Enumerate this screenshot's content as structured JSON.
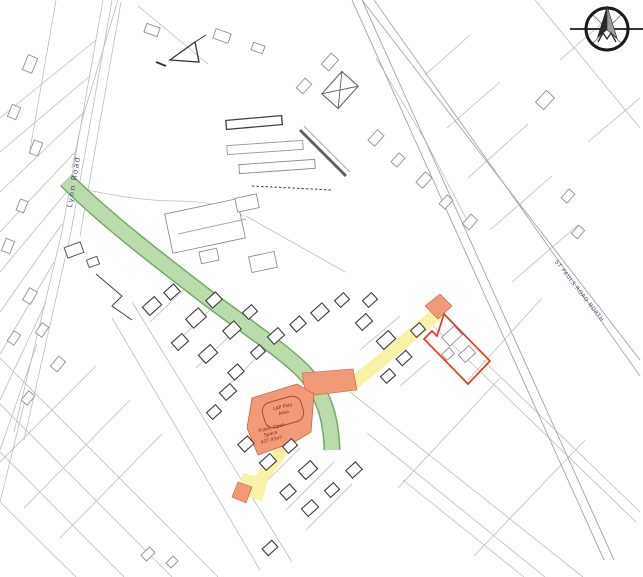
{
  "map": {
    "road_labels": {
      "lynn_road": "Lynn Road",
      "st_pauls_road_north": "ST PAULS ROAD NORTH"
    },
    "open_space": {
      "play_area_line1": "LAP Play",
      "play_area_line2": "Area",
      "label_line1": "Public Open",
      "label_line2": "Space",
      "area_value": "437.43m²"
    },
    "colors": {
      "highlight_green": "#b9dcaa",
      "highlight_green_edge": "#74ab67",
      "highlight_yellow": "#f7f2a6",
      "highlight_orange": "#f09a78",
      "highlight_orange_edge": "#d2603f",
      "site_boundary_red": "#e73a1e",
      "play_area_outline": "#b5472e",
      "annotation_text": "#7c2a16",
      "road_label_text": "#44506e"
    },
    "compass": {
      "icon": "compass-north-icon"
    }
  }
}
